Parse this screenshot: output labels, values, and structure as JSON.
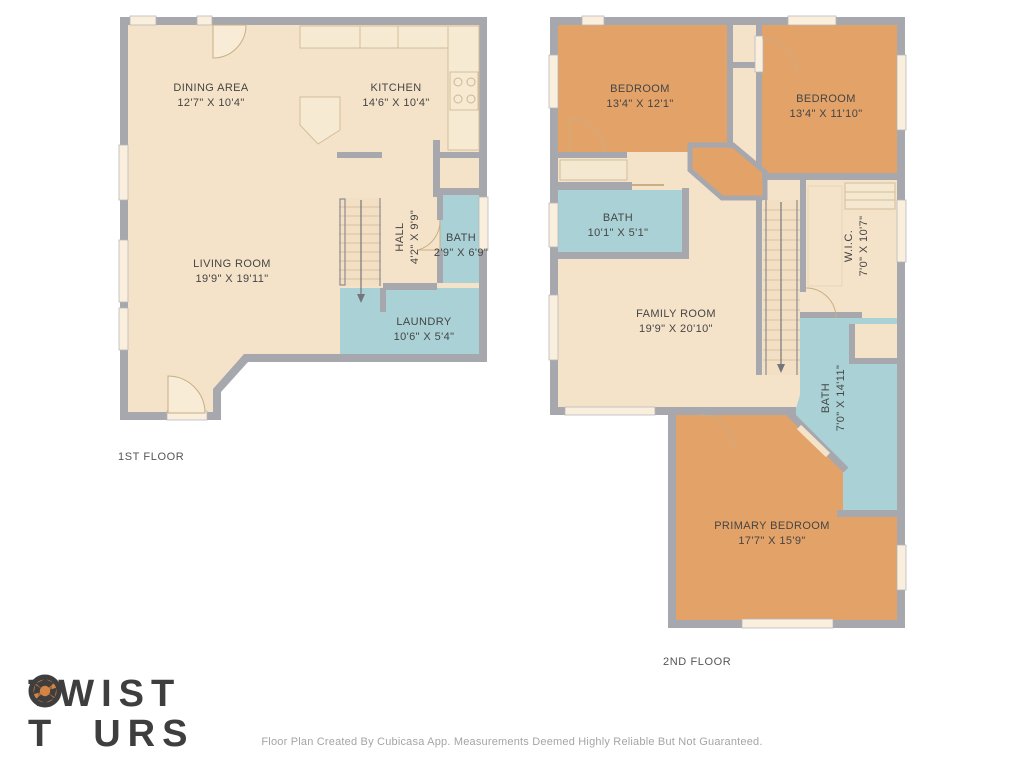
{
  "floor1": {
    "label": "1ST FLOOR",
    "rooms": {
      "dining": {
        "name": "DINING AREA",
        "dims": "12'7\" X 10'4\""
      },
      "kitchen": {
        "name": "KITCHEN",
        "dims": "14'6\" X 10'4\""
      },
      "living": {
        "name": "LIVING ROOM",
        "dims": "19'9\" X 19'11\""
      },
      "hall": {
        "name": "HALL",
        "dims": "4'2\" X 9'9\""
      },
      "bath": {
        "name": "BATH",
        "dims": "2'9\" X 6'9\""
      },
      "laundry": {
        "name": "LAUNDRY",
        "dims": "10'6\" X 5'4\""
      }
    }
  },
  "floor2": {
    "label": "2ND FLOOR",
    "rooms": {
      "bedroom1": {
        "name": "BEDROOM",
        "dims": "13'4\" X 12'1\""
      },
      "bedroom2": {
        "name": "BEDROOM",
        "dims": "13'4\" X 11'10\""
      },
      "bath1": {
        "name": "BATH",
        "dims": "10'1\" X 5'1\""
      },
      "family": {
        "name": "FAMILY ROOM",
        "dims": "19'9\" X 20'10\""
      },
      "wic": {
        "name": "W.I.C.",
        "dims": "7'0\" X 10'7\""
      },
      "bath2": {
        "name": "BATH",
        "dims": "7'0\" X 14'11\""
      },
      "primary": {
        "name": "PRIMARY BEDROOM",
        "dims": "17'7\" X 15'9\""
      }
    }
  },
  "logo": {
    "line1": "TWIST",
    "line2_prefix": "T",
    "line2_suffix": "URS"
  },
  "footer": "Floor Plan Created By Cubicasa App. Measurements Deemed Highly Reliable But Not Guaranteed.",
  "colors": {
    "wall": "#a7a7ae",
    "floor": "#f5e3c9",
    "bedroom_orange": "#e2a268",
    "wet_teal": "#aad2d6",
    "logo_dark": "#3e3e3e",
    "logo_orange": "#d28445"
  }
}
